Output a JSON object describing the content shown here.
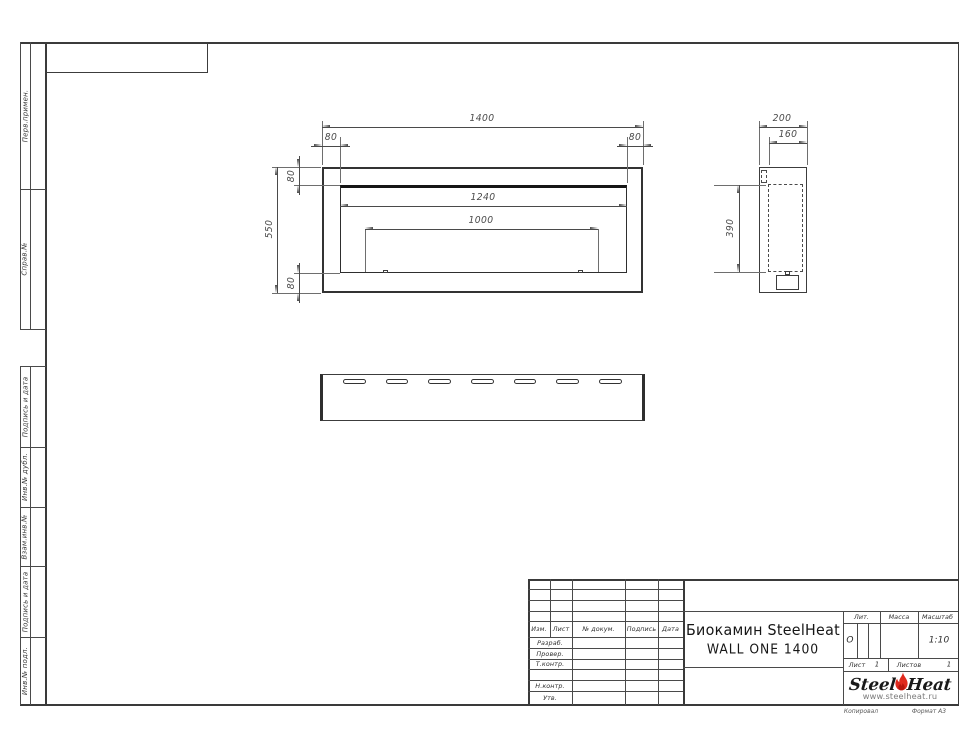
{
  "sheet": {
    "margin_labels": [
      "Перв.примен.",
      "Справ.№",
      "Подпись и дата",
      "Инв.№ дубл.",
      "Взам.инв.№",
      "Подпись и дата",
      "Инв.№ подл."
    ],
    "footer": {
      "copy": "Копировал",
      "format": "Формат А3"
    }
  },
  "views": {
    "front": {
      "dims": {
        "total_width": "1400",
        "offset_left": "80",
        "offset_right": "80",
        "total_height": "550",
        "offset_top": "80",
        "offset_bottom": "80",
        "opening_width": "1240",
        "burner_width": "1000"
      }
    },
    "side": {
      "dims": {
        "depth": "200",
        "inner_depth": "160",
        "inner_height": "390"
      }
    }
  },
  "title_block": {
    "cols": [
      "Изм.",
      "Лист",
      "№ докум.",
      "Подпись",
      "Дата"
    ],
    "rows": [
      "Разраб.",
      "Провер.",
      "Т.контр.",
      "",
      "Н.контр.",
      "Утв."
    ],
    "title_line1": "Биокамин SteelHeat",
    "title_line2": "WALL ONE 1400",
    "lit": {
      "label": "Лит.",
      "value": "О"
    },
    "mass": {
      "label": "Масса",
      "value": ""
    },
    "scale": {
      "label": "Масштаб",
      "value": "1:10"
    },
    "sheet_no": {
      "label": "Лист",
      "value": "1"
    },
    "sheets_total": {
      "label": "Листов",
      "value": "1"
    },
    "logo": {
      "steel": "Steel",
      "heat": "Heat",
      "url": "www.steelheat.ru"
    }
  },
  "colors": {
    "line": "#4a4a4a",
    "thick_line": "#1e1e1e",
    "dim_text": "#4a4a4a",
    "logo_red": "#e02a1e"
  }
}
